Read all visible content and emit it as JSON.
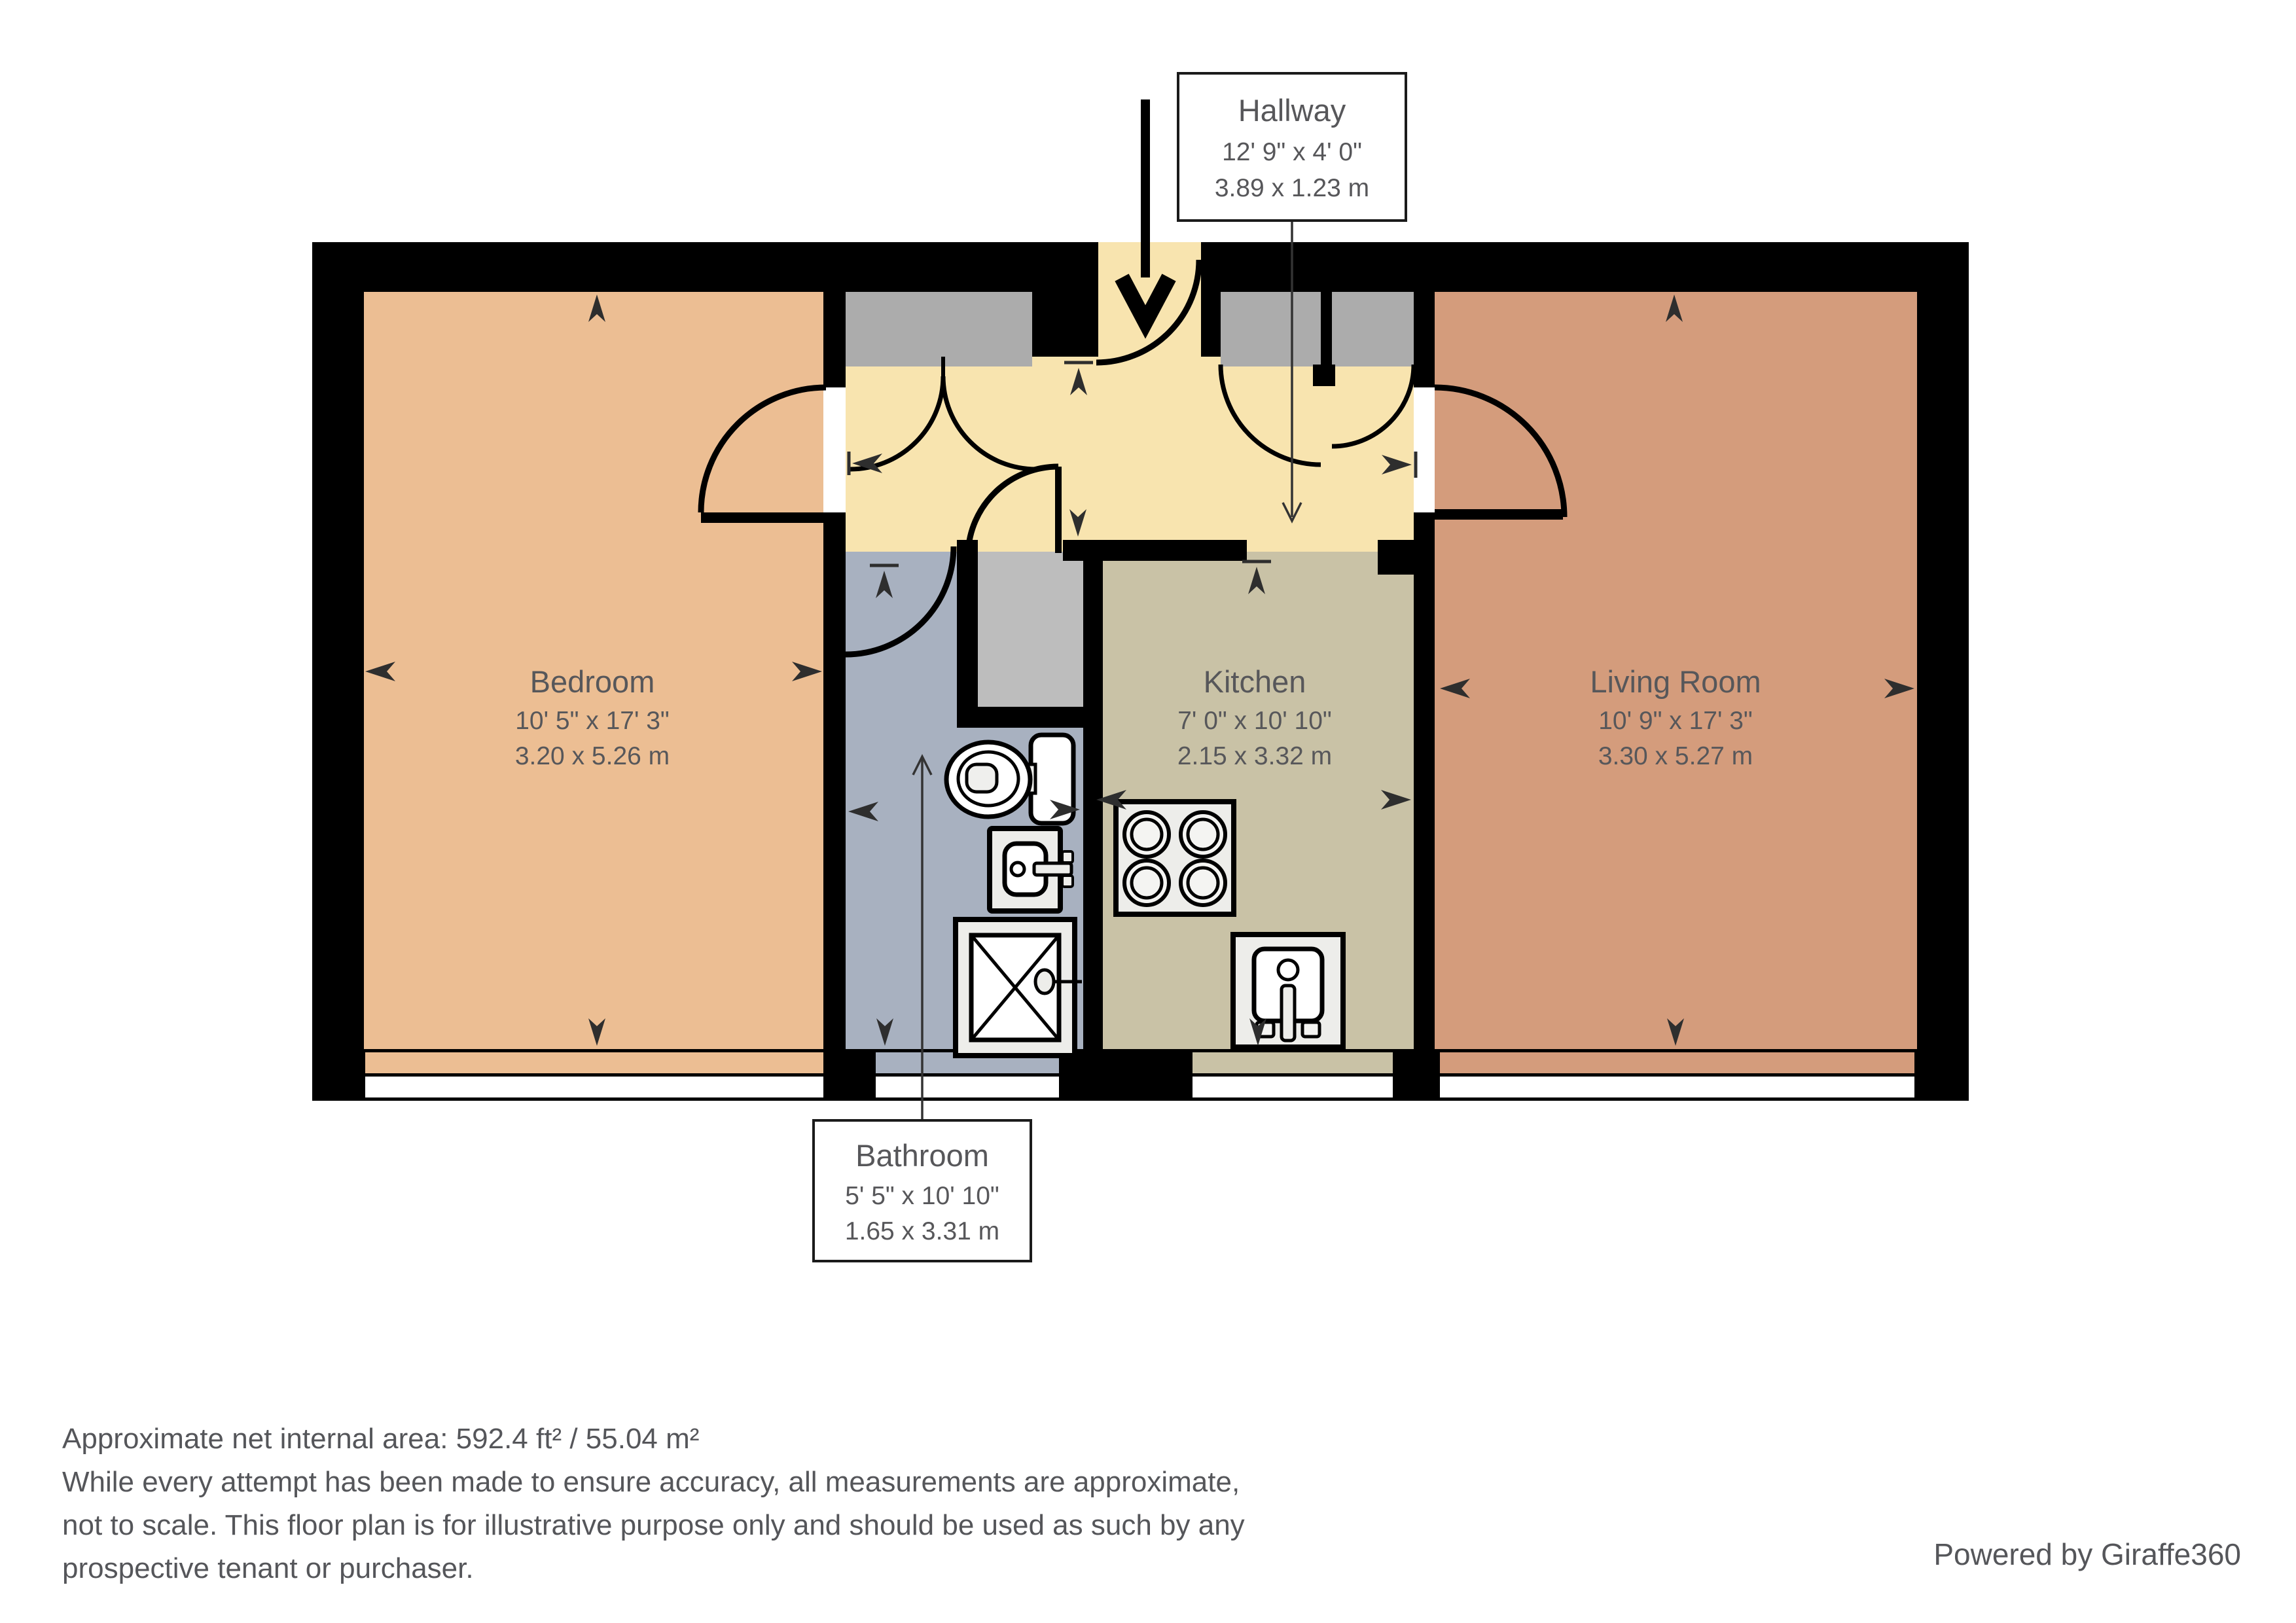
{
  "plan": {
    "hallway": {
      "name": "Hallway",
      "dims_imperial": "12' 9\" x 4' 0\"",
      "dims_metric": "3.89 x 1.23 m"
    },
    "bedroom": {
      "name": "Bedroom",
      "dims_imperial": "10' 5\" x 17' 3\"",
      "dims_metric": "3.20 x 5.26 m"
    },
    "bathroom": {
      "name": "Bathroom",
      "dims_imperial": "5' 5\" x 10' 10\"",
      "dims_metric": "1.65 x 3.31 m"
    },
    "kitchen": {
      "name": "Kitchen",
      "dims_imperial": "7' 0\" x 10' 10\"",
      "dims_metric": "2.15 x 3.32 m"
    },
    "living_room": {
      "name": "Living Room",
      "dims_imperial": "10' 9\" x 17' 3\"",
      "dims_metric": "3.30 x 5.27 m"
    }
  },
  "colors": {
    "bedroom": "#ECBE93",
    "hallway": "#F8E4AF",
    "bathroom": "#A8B1C0",
    "kitchen": "#C9C2A6",
    "living_room": "#D49C7C",
    "closet": "#ACACAC",
    "closet_mid": "#BDBDBD",
    "wall": "#000000",
    "window": "#FFFFFF",
    "fixture": "#EDEDEA",
    "label_text": "#57575A",
    "footer_text": "#55565A"
  },
  "footer": {
    "area_line": "Approximate net internal area: 592.4 ft² / 55.04 m²",
    "disclaimer_line1": "While every attempt has been made to ensure accuracy, all measurements are approximate,",
    "disclaimer_line2": "not to scale. This floor plan is for illustrative purpose only and should be used as such by any",
    "disclaimer_line3": "prospective tenant or purchaser.",
    "powered_by": "Powered by Giraffe360"
  }
}
